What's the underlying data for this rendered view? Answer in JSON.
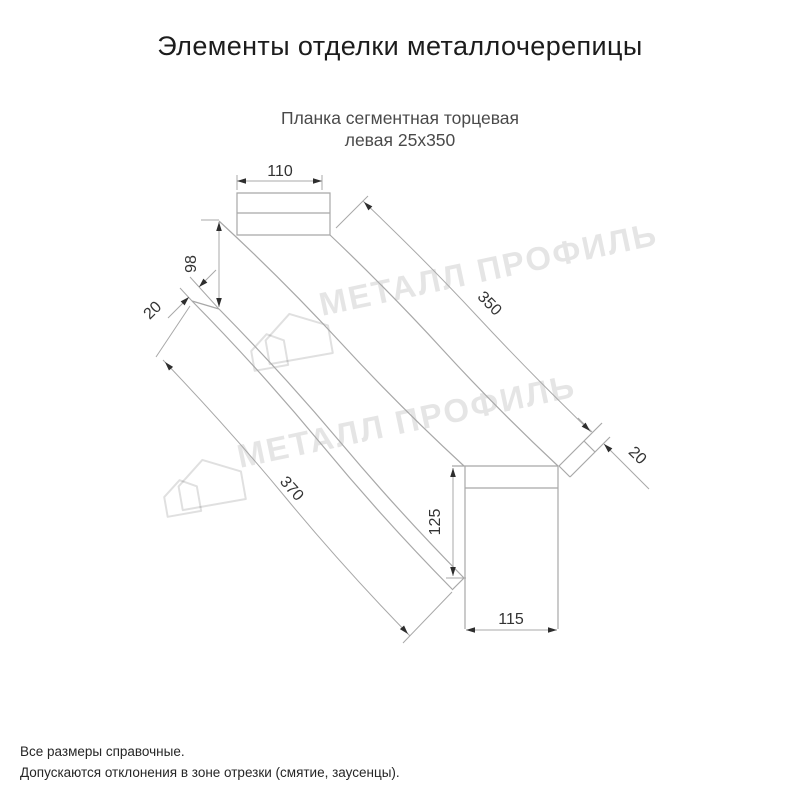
{
  "header": {
    "title": "Элементы отделки металлочерепицы",
    "subtitle_line1": "Планка сегментная торцевая",
    "subtitle_line2": "левая 25х350"
  },
  "watermark": {
    "text": "МЕТАЛЛ ПРОФИЛЬ"
  },
  "dimensions": {
    "top_width": "110",
    "left_height": "98",
    "left_fold": "20",
    "top_length": "350",
    "bottom_length": "370",
    "end_height": "125",
    "end_width": "115",
    "end_fold": "20"
  },
  "footer": {
    "line1": "Все размеры справочные.",
    "line2": "Допускаются отклонения в зоне отрезки (смятие, заусенцы)."
  },
  "colors": {
    "drawing_line": "#a8a8a8",
    "dimension_text": "#333333",
    "title_text": "#1c1c1c",
    "subtitle_text": "#4a4a4a",
    "watermark": "rgba(0,0,0,0.10)"
  }
}
